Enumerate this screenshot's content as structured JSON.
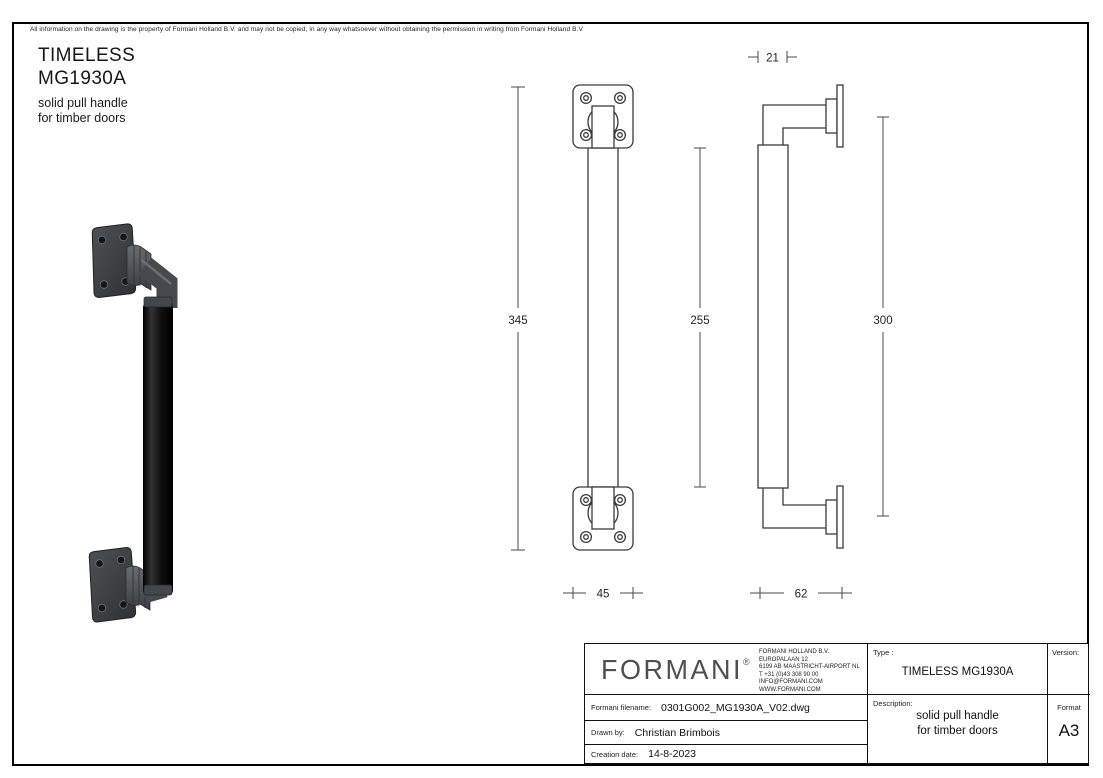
{
  "sheet": {
    "disclaimer": "All information on the drawing is the property of Formani Holland B.V. and may not be copied, in any way whatsoever without obtaining the permission in writing from Formani Holland B.V",
    "product": {
      "series": "TIMELESS",
      "model": "MG1930A",
      "description_line1": "solid pull handle",
      "description_line2": "for timber doors"
    }
  },
  "dimensions": {
    "total_height": "345",
    "grip_length": "255",
    "fixing_centers": "300",
    "grip_diameter": "21",
    "rosette_width": "45",
    "projection": "62"
  },
  "title_block": {
    "logo": "FORMANI",
    "logo_reg": "®",
    "contact": [
      "FORMANI HOLLAND B.V.",
      "EUROPALAAN 12",
      "6199 AB MAASTRICHT-AIRPORT NL",
      "T +31 (0)43 308 90 00",
      "INFO@FORMANI.COM",
      "WWW.FORMANI.COM"
    ],
    "type_label": "Type :",
    "type_value": "TIMELESS MG1930A",
    "version_label": "Version:",
    "version_value": "",
    "filename_label": "Formani filename:",
    "filename_value": "0301G002_MG1930A_V02.dwg",
    "drawn_by_label": "Drawn by:",
    "drawn_by_value": "Christian Brimbois",
    "creation_date_label": "Creation date:",
    "creation_date_value": "14-8-2023",
    "description_label": "Description:",
    "description_line1": "solid pull handle",
    "description_line2": "for timber doors",
    "format_label": "Format",
    "format_value": "A3",
    "colors": {
      "line": "#3a3a3a",
      "dimension": "#4a4a4a",
      "grip_black": "#0d0d0d",
      "metal_gray": "#45494d"
    }
  }
}
